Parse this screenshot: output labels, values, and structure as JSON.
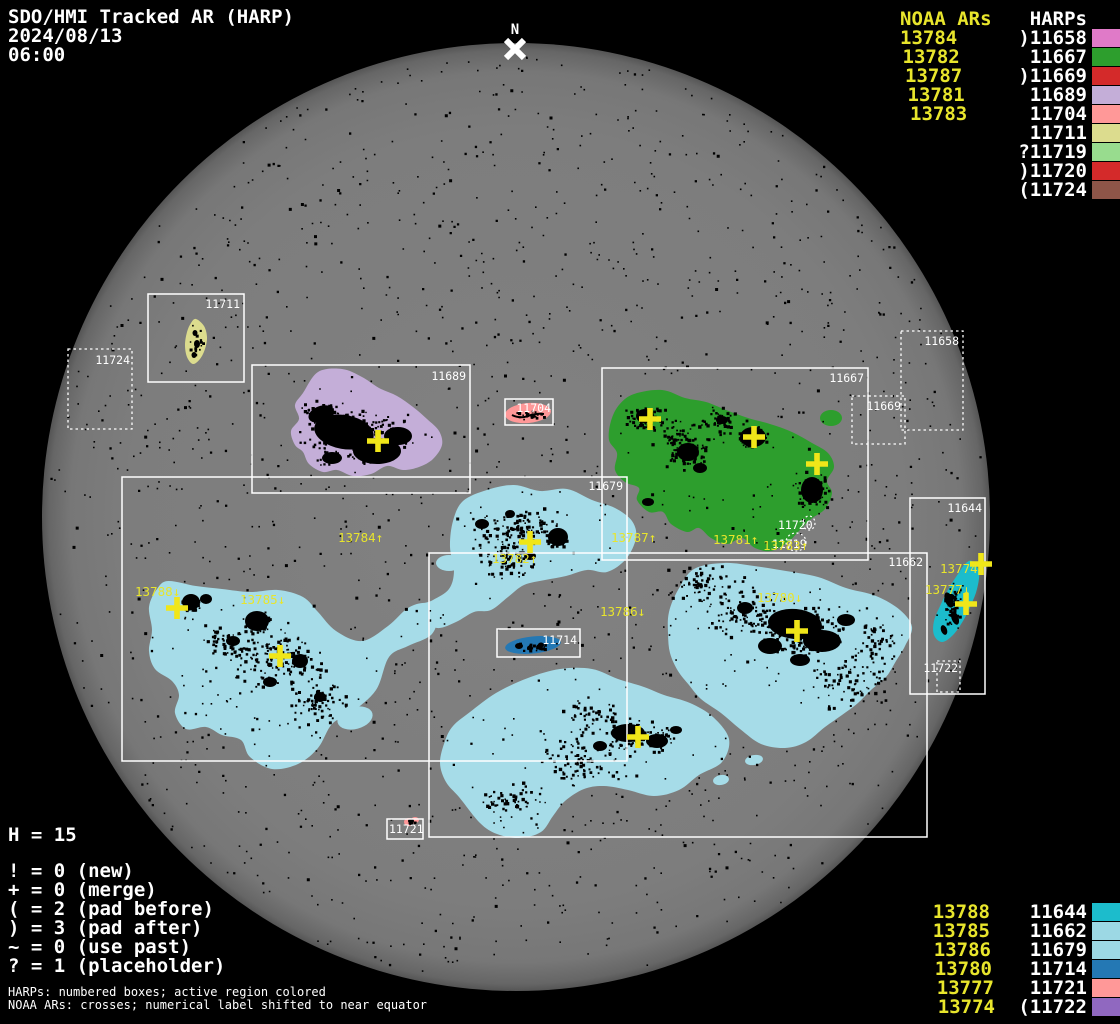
{
  "title": {
    "line1": "SDO/HMI Tracked AR (HARP)",
    "date": "2024/08/13",
    "time": "06:00"
  },
  "north_label": "N",
  "legend_top": {
    "noaa_header": "NOAA ARs",
    "harp_header": "HARPs",
    "noaa": [
      "13784",
      "13782",
      "13787",
      "13781",
      "13783"
    ],
    "harps": [
      {
        "label": ")11658",
        "color": "#e07ac8"
      },
      {
        "label": "11667",
        "color": "#2d9e2d"
      },
      {
        "label": ")11669",
        "color": "#d42a2a"
      },
      {
        "label": "11689",
        "color": "#c4aed8"
      },
      {
        "label": "11704",
        "color": "#ff9898"
      },
      {
        "label": "11711",
        "color": "#dcdc8e"
      },
      {
        "label": "?11719",
        "color": "#98dc8e"
      },
      {
        "label": ")11720",
        "color": "#d42a2a"
      },
      {
        "label": "(11724",
        "color": "#8e5548"
      }
    ]
  },
  "legend_bottom": {
    "noaa": [
      "13788",
      "13785",
      "13786",
      "13780",
      "13777",
      "13774"
    ],
    "harps": [
      {
        "label": "11644",
        "color": "#1cbccc"
      },
      {
        "label": "11662",
        "color": "#9cd8e4"
      },
      {
        "label": "11679",
        "color": "#9cd8e4"
      },
      {
        "label": "11714",
        "color": "#2478b4"
      },
      {
        "label": "11721",
        "color": "#ff9898"
      },
      {
        "label": "(11722",
        "color": "#9068c0"
      }
    ]
  },
  "stats": {
    "h_line": "H = 15",
    "symbols": [
      "! = 0 (new)",
      "+ = 0 (merge)",
      "( = 2 (pad before)",
      ") = 3 (pad after)",
      "~ = 0 (use past)",
      "? = 1 (placeholder)"
    ]
  },
  "footnotes": [
    "HARPs: numbered boxes; active region colored",
    "NOAA ARs: crosses; numerical label shifted to near equator"
  ],
  "colors": {
    "background": "#000000",
    "disk": "#7d7d7d",
    "yellow_text": "#e8e52c",
    "white_text": "#ffffff",
    "cross": "#f0e619"
  },
  "chart_data": {
    "type": "scatter",
    "title": "SDO/HMI Tracked AR (HARP) 2024/08/13 06:00",
    "notes": "Solar disk map: HARP bounding boxes (numbered) with colored active regions; NOAA AR crosses with labels shifted toward equator",
    "harp_total": 15,
    "disk": {
      "cx": 516,
      "cy": 517,
      "r": 474
    },
    "region_colors": {
      "11679": "#a6dce8",
      "11662": "#a6dce8",
      "11667": "#2d9e2d",
      "11689": "#c4aed8",
      "11711": "#dcdc8e",
      "11704": "#ff9898",
      "11714": "#2478b4",
      "11644": "#1cbccc",
      "11721": "#ff9898"
    },
    "harp_boxes": [
      {
        "harp": "11711",
        "x": 148,
        "y": 294,
        "w": 96,
        "h": 88,
        "dashed": false,
        "lx": 240,
        "ly": 308,
        "anchor": "end"
      },
      {
        "harp": "11724",
        "x": 68,
        "y": 349,
        "w": 64,
        "h": 80,
        "dashed": true,
        "lx": 130,
        "ly": 364,
        "anchor": "end"
      },
      {
        "harp": "11689",
        "x": 252,
        "y": 365,
        "w": 218,
        "h": 128,
        "dashed": false,
        "lx": 466,
        "ly": 380,
        "anchor": "end"
      },
      {
        "harp": "11704",
        "x": 505,
        "y": 399,
        "w": 48,
        "h": 26,
        "dashed": false,
        "lx": 551,
        "ly": 412,
        "anchor": "end"
      },
      {
        "harp": "11667",
        "x": 602,
        "y": 368,
        "w": 266,
        "h": 192,
        "dashed": false,
        "lx": 864,
        "ly": 382,
        "anchor": "end"
      },
      {
        "harp": "11669",
        "x": 852,
        "y": 396,
        "w": 53,
        "h": 48,
        "dashed": true,
        "lx": 901,
        "ly": 410,
        "anchor": "end"
      },
      {
        "harp": "11658",
        "x": 901,
        "y": 331,
        "w": 62,
        "h": 99,
        "dashed": true,
        "lx": 959,
        "ly": 345,
        "anchor": "end"
      },
      {
        "harp": "11679",
        "x": 122,
        "y": 477,
        "w": 505,
        "h": 284,
        "dashed": false,
        "lx": 623,
        "ly": 490,
        "anchor": "end"
      },
      {
        "harp": "11662",
        "x": 429,
        "y": 553,
        "w": 498,
        "h": 284,
        "dashed": false,
        "lx": 923,
        "ly": 566,
        "anchor": "end"
      },
      {
        "harp": "11644",
        "x": 910,
        "y": 498,
        "w": 75,
        "h": 196,
        "dashed": false,
        "lx": 982,
        "ly": 512,
        "anchor": "end"
      },
      {
        "harp": "11714",
        "x": 497,
        "y": 629,
        "w": 83,
        "h": 28,
        "dashed": false,
        "lx": 577,
        "ly": 644,
        "anchor": "end"
      },
      {
        "harp": "11721",
        "x": 387,
        "y": 819,
        "w": 36,
        "h": 20,
        "dashed": false,
        "lx": 389,
        "ly": 833,
        "anchor": "start"
      },
      {
        "harp": "11722",
        "x": 937,
        "y": 661,
        "w": 23,
        "h": 31,
        "dashed": true,
        "lx": 958,
        "ly": 672,
        "anchor": "end"
      }
    ],
    "noaa_crosses": [
      {
        "noaa": "13784",
        "x": 378,
        "y": 441
      },
      {
        "noaa": "13782",
        "x": 530,
        "y": 542
      },
      {
        "noaa": "13787",
        "x": 650,
        "y": 419
      },
      {
        "noaa": "13781",
        "x": 754,
        "y": 437
      },
      {
        "noaa": "13783",
        "x": 817,
        "y": 464
      },
      {
        "noaa": "13788",
        "x": 177,
        "y": 608
      },
      {
        "noaa": "13785",
        "x": 280,
        "y": 656
      },
      {
        "noaa": "13786",
        "x": 638,
        "y": 737
      },
      {
        "noaa": "13780",
        "x": 797,
        "y": 631
      },
      {
        "noaa": "13777",
        "x": 966,
        "y": 604
      },
      {
        "noaa": "13774",
        "x": 981,
        "y": 564
      }
    ],
    "noaa_disk_labels": [
      {
        "text": "13784↑",
        "x": 338,
        "y": 542
      },
      {
        "text": "13782↑",
        "x": 492,
        "y": 563
      },
      {
        "text": "13787↑",
        "x": 611,
        "y": 542
      },
      {
        "text": "13781↑",
        "x": 713,
        "y": 544
      },
      {
        "text": "13783↑",
        "x": 763,
        "y": 550
      },
      {
        "text": "13788↓",
        "x": 135,
        "y": 596
      },
      {
        "text": "13785↓",
        "x": 240,
        "y": 604
      },
      {
        "text": "13786↓",
        "x": 600,
        "y": 616
      },
      {
        "text": "13780↓",
        "x": 757,
        "y": 602
      },
      {
        "text": "13777↓",
        "x": 925,
        "y": 594
      },
      {
        "text": "13774↑",
        "x": 940,
        "y": 573
      }
    ],
    "placeholder_marks": [
      {
        "text": "11720",
        "tx": 778,
        "ty": 529,
        "cx": 809,
        "cy": 523,
        "rx": 6,
        "ry": 7
      },
      {
        "text": "11719",
        "tx": 772,
        "ty": 548,
        "cx": 796,
        "cy": 542,
        "rx": 10,
        "ry": 9
      }
    ]
  }
}
